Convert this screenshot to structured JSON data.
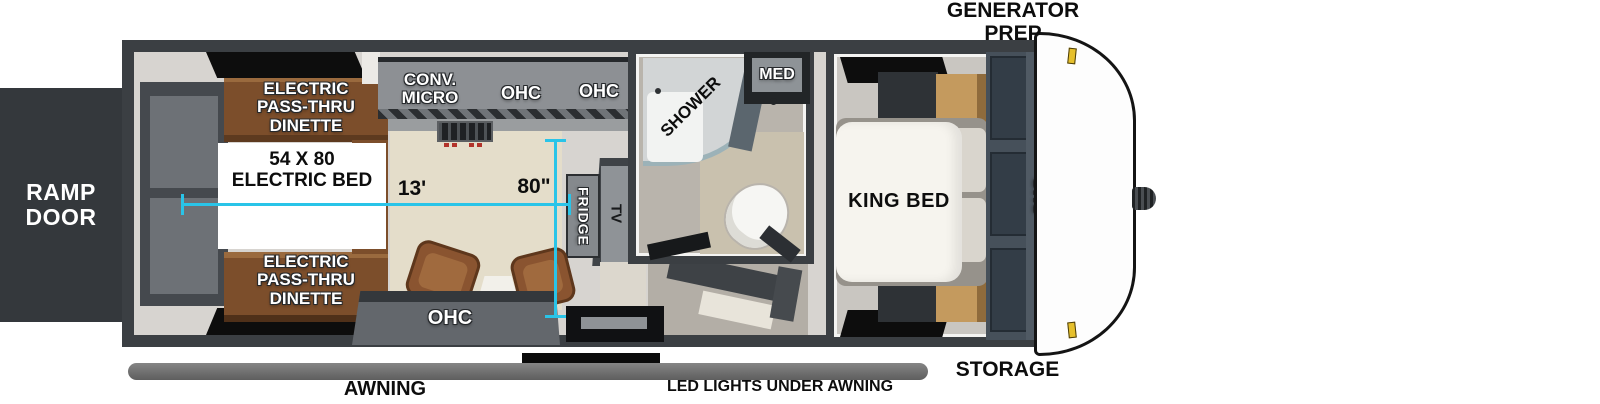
{
  "exterior": {
    "generator_prep": "GENERATOR\nPREP",
    "ramp_door": "RAMP\nDOOR",
    "storage": "STORAGE",
    "awning": "AWNING",
    "led_lights": "LED LIGHTS UNDER AWNING"
  },
  "garage": {
    "dinette_top": "ELECTRIC\nPASS-THRU\nDINETTE",
    "dinette_bottom": "ELECTRIC\nPASS-THRU\nDINETTE",
    "electric_bed": "54 X 80\nELECTRIC BED",
    "ohc_sofa": "OHC"
  },
  "kitchen": {
    "conv_micro": "CONV.\nMICRO",
    "ohc_left": "OHC",
    "ohc_right": "OHC",
    "fridge": "FRIDGE",
    "tv": "TV"
  },
  "bathroom": {
    "shower": "SHOWER",
    "med": "MED"
  },
  "bedroom": {
    "king_bed": "KING BED",
    "ohc": "OHC"
  },
  "dimensions": {
    "garage_length": "13'",
    "garage_width": "80\""
  },
  "colors": {
    "measure_line": "#29c4e8",
    "wall": "#3b3f43",
    "dinette_wood": "#7c4e2b",
    "nightstand_wood": "#c49a5e",
    "clearance_light": "#e6c02c"
  }
}
